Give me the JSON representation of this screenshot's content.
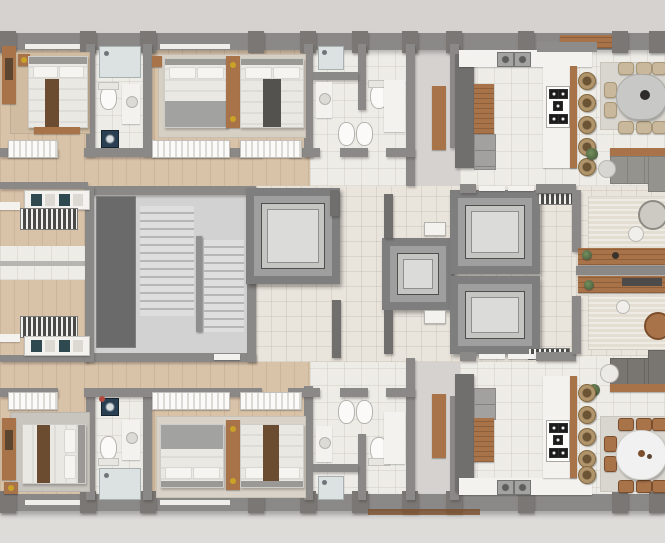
{
  "scene": {
    "description": "Top-down 3D architectural floor plan of a residential tower level: two mirrored apartments (left bedroom wing with wood floors, right kitchen-living-dining wing) around a central core with a U-shaped stairwell and four elevators",
    "view": "top-down render",
    "visible_text": ""
  },
  "inventory": {
    "apartments": 2,
    "bedrooms": 4,
    "beds": 6,
    "bathrooms": 6,
    "walk_in_closets": 2,
    "washing_machines": 2,
    "elevators": 4,
    "stairwells": 1,
    "kitchens": 2,
    "kitchen_islands": 2,
    "bar_stools": 10,
    "dining_tables": 2,
    "dining_chairs": 16,
    "sofas": 2,
    "coffee_tables": 4,
    "consoles": 2
  },
  "palette": {
    "bg": "#d5d2cf",
    "bgBottom": "#dedcd9",
    "wood": "#d8c3a9",
    "tile": "#edece7",
    "cream": "#e9e4dc",
    "wall": "#8b8987",
    "wallDark": "#716f6d",
    "pilaster": "#7a7774",
    "sill": "#efeeea",
    "stairFloor": "#d2d2d2",
    "shaft": "#6a6a6a",
    "elevOuter": "#7e7e7e",
    "elevFrame": "#9f9f9f",
    "elevInner": "#c5c5c3",
    "elevCab": "#dbdbd9",
    "white": "#f3f2ef",
    "woodFurn": "#a9734a",
    "woodFurnDark": "#7c4e2b",
    "bedWhite": "#eae8e3",
    "pillow": "#f5f4f1",
    "headboard": "#9b9996",
    "blanketGray": "#a2a2a0",
    "runnerBrown": "#6b4c31",
    "runnerDark": "#54524e",
    "teal": "#2e4a50",
    "sofa": "#95938e",
    "sofaDark": "#797672",
    "stool": "#b0946b",
    "stoolDark": "#6b5434",
    "chairBeige": "#c9b89b",
    "marble": "#c8c8c6",
    "rugLight": "#e3ddd2",
    "rugGray": "#c8c4be",
    "rugBeige": "#cfbca1",
    "rugDining": "#d9d6d0",
    "glass": "#dce1e2",
    "appliance": "#a2a19f",
    "navy": "#2a3f52",
    "gold": "#c9a227",
    "plantGreen": "#5a7248",
    "accentRed": "#b04a3e"
  }
}
